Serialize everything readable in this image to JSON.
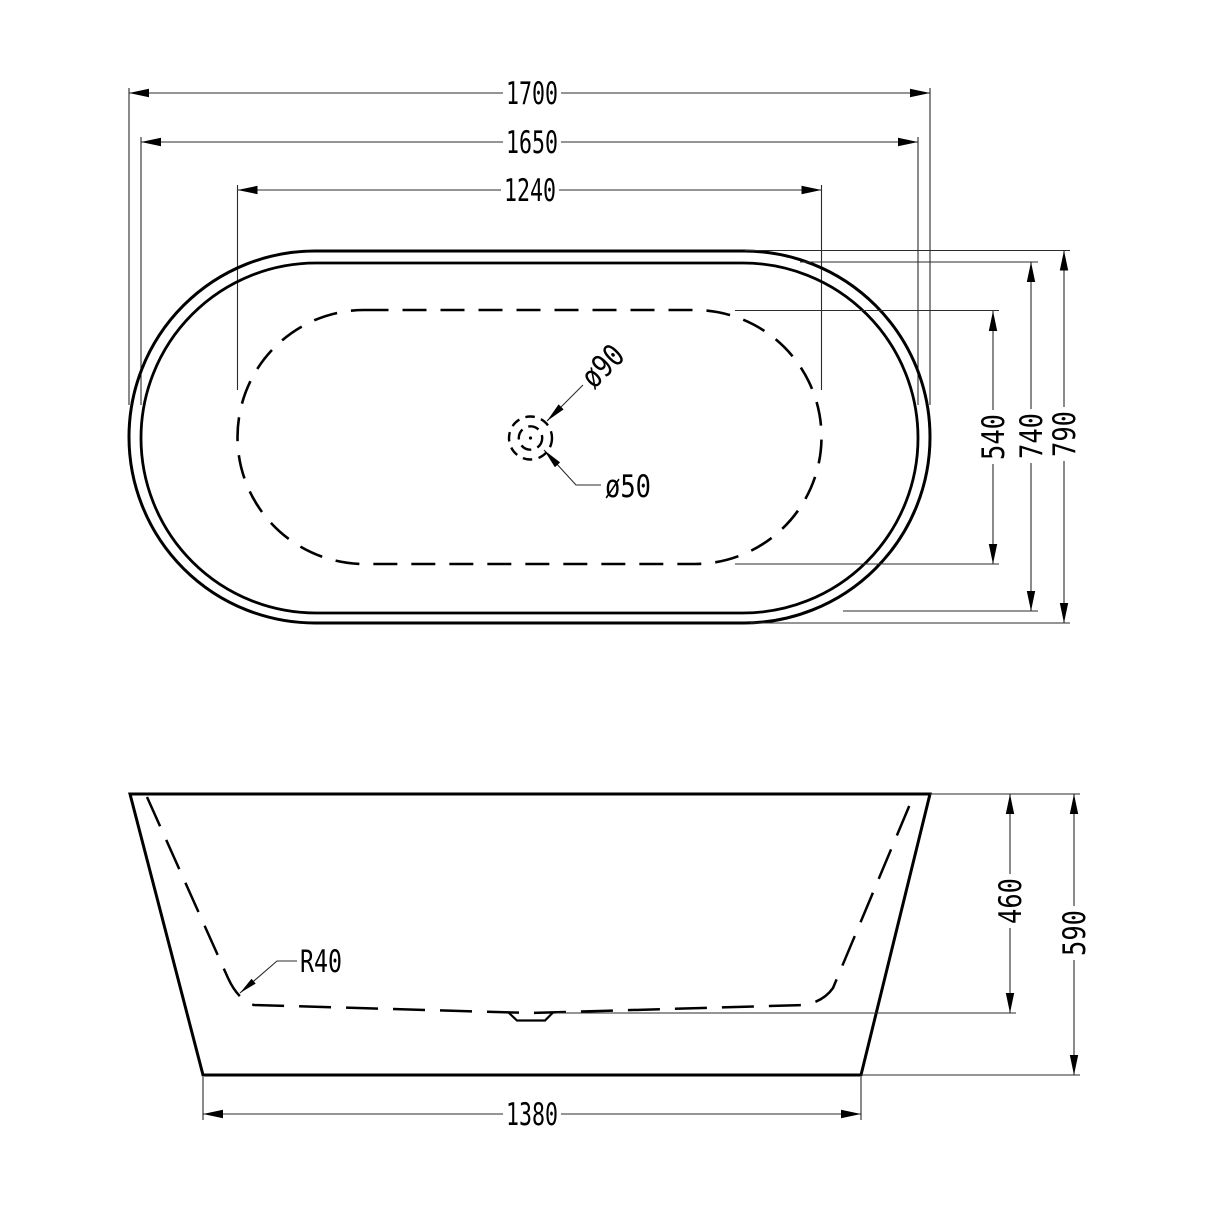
{
  "page": {
    "background": "#ffffff"
  },
  "colors": {
    "line": "#000000",
    "dim_line": "#2b2b2b",
    "text": "#000000"
  },
  "top_view": {
    "name": "Bathtub plan view (top)",
    "dimensions": {
      "overall_length": "1700",
      "rim_length": "1650",
      "floor_length": "1240",
      "floor_width": "540",
      "rim_width": "740",
      "overall_width": "790"
    },
    "drain": {
      "outer_diameter": "ø90",
      "inner_diameter": "ø50"
    }
  },
  "side_view": {
    "name": "Bathtub side elevation",
    "dimensions": {
      "base_length": "1380",
      "inner_depth": "460",
      "overall_height": "590",
      "bottom_radius": "R40"
    }
  }
}
